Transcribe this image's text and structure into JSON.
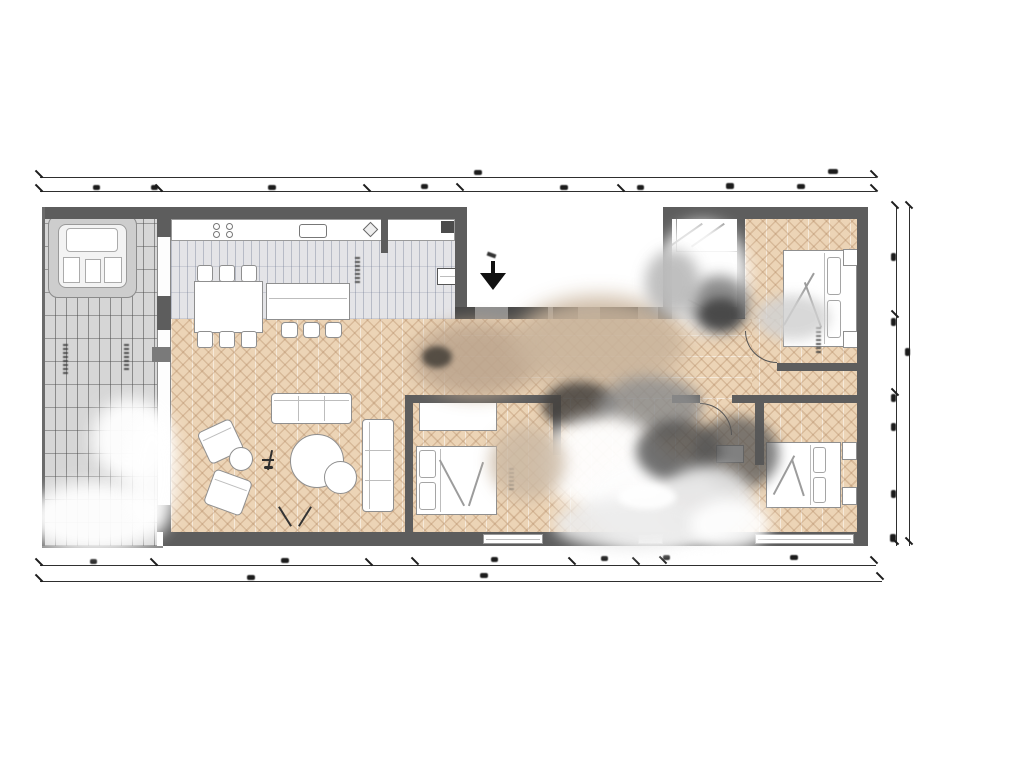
{
  "document": {
    "type": "architectural-floor-plan",
    "background": "#ffffff",
    "visible_text": [],
    "dimension_labels_legible": false
  },
  "palette": {
    "wall": "#5d5d5d",
    "wall_light": "#8f8f8f",
    "wood_floor": "#ecd4b6",
    "wood_stroke": "#a87c56",
    "kitchen_tile": "#e4e4e7",
    "terrace_tile": "#d6d6d6",
    "furniture_fill": "#ffffff",
    "furniture_stroke": "#8f8f8f",
    "dimension_ink": "#1d1d1d",
    "smudge_dark": "#4a4a4a",
    "smudge_tan": "#c9b49c"
  },
  "rooms": [
    {
      "id": "terrace",
      "floor": "gray-tile-grid",
      "furniture": [
        "hot-tub"
      ],
      "labels": [
        "illegible-vertical-label",
        "illegible-vertical-label"
      ]
    },
    {
      "id": "kitchen-dining",
      "floor": "gray-tile",
      "furniture": [
        "kitchen-counter",
        "cooktop-4-burners",
        "sink",
        "dining-table",
        "dining-chairs-x6",
        "kitchen-island",
        "bar-stools-x3",
        "radiator",
        "wall-cabinet"
      ]
    },
    {
      "id": "living-room",
      "floor": "herringbone-wood",
      "furniture": [
        "sofa-3-seat",
        "chaise-sofa",
        "armchair",
        "armchair",
        "side-table-round",
        "floor-lamp",
        "coffee-table-round-large",
        "coffee-table-round-small"
      ],
      "annotations": [
        "window-v-mark"
      ]
    },
    {
      "id": "entrance-courtyard",
      "floor": "exterior-white",
      "annotations": [
        "entrance-arrow-down"
      ]
    },
    {
      "id": "bathroom",
      "floor": "white",
      "furniture": [
        "shower"
      ],
      "condition": "heavily-smudged"
    },
    {
      "id": "bedroom-top-right",
      "floor": "herringbone-wood",
      "furniture": [
        "double-bed",
        "nightstand",
        "nightstand"
      ],
      "labels": [
        "illegible-vertical-label"
      ]
    },
    {
      "id": "bedroom-middle",
      "floor": "herringbone-wood",
      "furniture": [
        "wardrobe",
        "double-bed"
      ],
      "labels": [
        "illegible-vertical-label"
      ]
    },
    {
      "id": "bedroom-bottom-right",
      "floor": "herringbone-wood",
      "furniture": [
        "double-bed",
        "nightstand",
        "nightstand",
        "desk"
      ]
    },
    {
      "id": "hallway",
      "floor": "herringbone-wood-horizontal",
      "condition": "heavily-smudged"
    }
  ],
  "dimension_annotations": {
    "top": {
      "lines": 2,
      "tick_marks": true,
      "labels": "illegible-blurred"
    },
    "bottom": {
      "lines": 2,
      "tick_marks": true,
      "labels": "illegible-blurred"
    },
    "right": {
      "lines": 2,
      "tick_marks": true,
      "labels": "illegible-blurred"
    }
  }
}
